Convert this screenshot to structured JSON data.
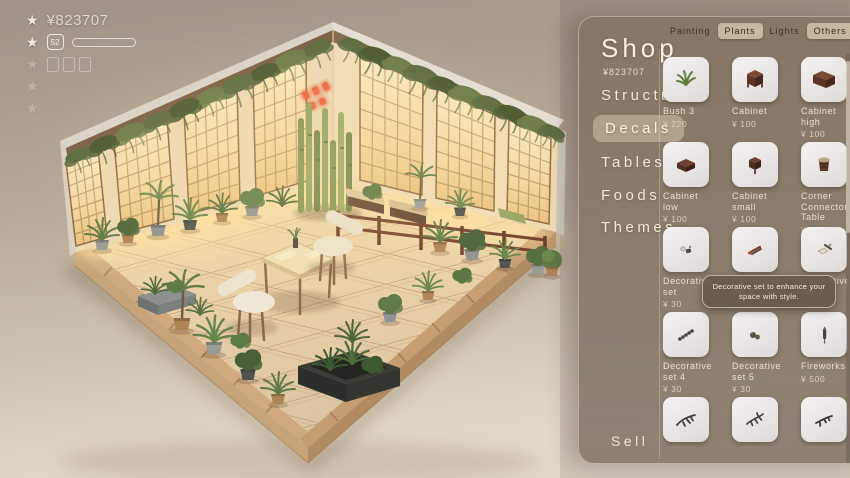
{
  "hud": {
    "currency": "¥823707",
    "level": "52"
  },
  "shop": {
    "title": "Shop",
    "balance": "¥823707",
    "sell_label": "Sell",
    "tooltip": "Decorative set to enhance your space with style.",
    "tabs": [
      {
        "label": "Painting"
      },
      {
        "label": "Plants"
      },
      {
        "label": "Lights"
      },
      {
        "label": "Others"
      }
    ],
    "categories": [
      {
        "label": "Structure"
      },
      {
        "label": "Decals"
      },
      {
        "label": "Tables"
      },
      {
        "label": "Foods"
      },
      {
        "label": "Themes"
      }
    ],
    "items": [
      {
        "name": "Bush 3",
        "price": "¥ 220"
      },
      {
        "name": "Cabinet",
        "price": "¥ 100"
      },
      {
        "name": "Cabinet high",
        "price": "¥ 100"
      },
      {
        "name": "Cabinet low",
        "price": "¥ 100"
      },
      {
        "name": "Cabinet small",
        "price": "¥ 100"
      },
      {
        "name": "Corner Connector Table",
        "price": "¥ 100"
      },
      {
        "name": "Decorative set",
        "price": "¥ 30"
      },
      {
        "name": "Decorative set 2",
        "price": ""
      },
      {
        "name": "Decorative set 3",
        "price": "¥ 30"
      },
      {
        "name": "Decorative set 4",
        "price": "¥ 30"
      },
      {
        "name": "Decorative set 5",
        "price": "¥ 30"
      },
      {
        "name": "Fireworks",
        "price": "¥ 500"
      },
      {
        "name": "",
        "price": ""
      },
      {
        "name": "",
        "price": ""
      },
      {
        "name": "",
        "price": ""
      }
    ]
  },
  "colors": {
    "accent_warm": "#f3d79f",
    "panel_brown": "#7d6d5c",
    "neon_red": "#e05438",
    "foliage_green": "#5d7a45"
  }
}
